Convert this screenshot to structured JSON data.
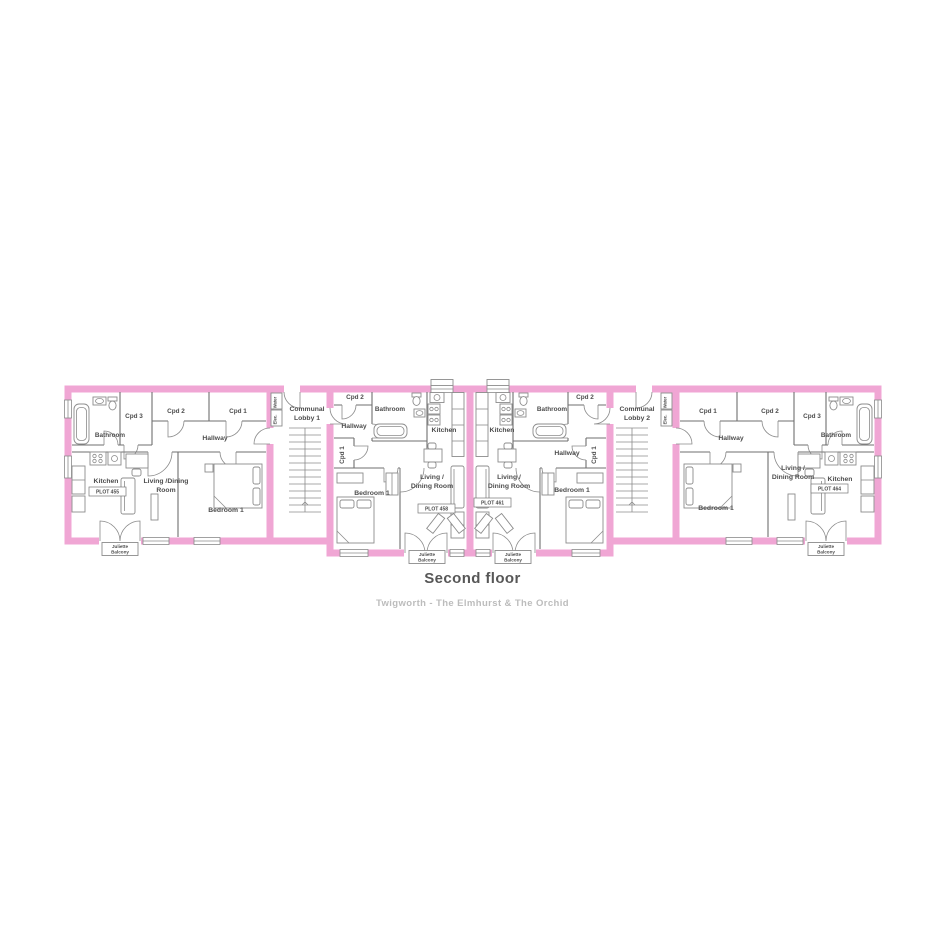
{
  "page": {
    "title": "Second floor",
    "subtitle": "Twigworth - The Elmhurst & The Orchid"
  },
  "colors": {
    "wall_pink": "#f0a6d4",
    "interior_line": "#6f6f6f",
    "fixture_line": "#8c8c8c",
    "label_text": "#4d4d4d",
    "title_text": "#575757",
    "subtitle_text": "#bcbcbc"
  },
  "strings": {
    "balcony_line1": "Juliette",
    "balcony_line2": "Balcony",
    "elec": "Elec.",
    "water": "Water"
  },
  "lobbies": [
    {
      "line1": "Communal",
      "line2": "Lobby 1"
    },
    {
      "line1": "Communal",
      "line2": "Lobby 2"
    }
  ],
  "apartments": [
    {
      "plot": "PLOT 455",
      "rooms": {
        "bathroom": "Bathroom",
        "cpd1": "Cpd 1",
        "cpd2": "Cpd 2",
        "cpd3": "Cpd 3",
        "hallway": "Hallway",
        "kitchen": "Kitchen",
        "living_line1": "Living /Dining",
        "living_line2": "Room",
        "bedroom": "Bedroom 1"
      }
    },
    {
      "plot": "PLOT 458",
      "rooms": {
        "bathroom": "Bathroom",
        "cpd1": "Cpd 1",
        "cpd2": "Cpd 2",
        "hallway": "Hallway",
        "kitchen": "Kitchen",
        "living_line1": "Living /",
        "living_line2": "Dining Room",
        "bedroom": "Bedroom 1"
      }
    },
    {
      "plot": "PLOT 461",
      "rooms": {
        "bathroom": "Bathroom",
        "cpd1": "Cpd 1",
        "cpd2": "Cpd 2",
        "hallway": "Hallway",
        "kitchen": "Kitchen",
        "living_line1": "Living /",
        "living_line2": "Dining Room",
        "bedroom": "Bedroom 1"
      }
    },
    {
      "plot": "PLOT 464",
      "rooms": {
        "bathroom": "Bathroom",
        "cpd1": "Cpd 1",
        "cpd2": "Cpd 2",
        "cpd3": "Cpd 3",
        "hallway": "Hallway",
        "kitchen": "Kitchen",
        "living_line1": "Living /",
        "living_line2": "Dining Room",
        "bedroom": "Bedroom 1"
      }
    }
  ]
}
